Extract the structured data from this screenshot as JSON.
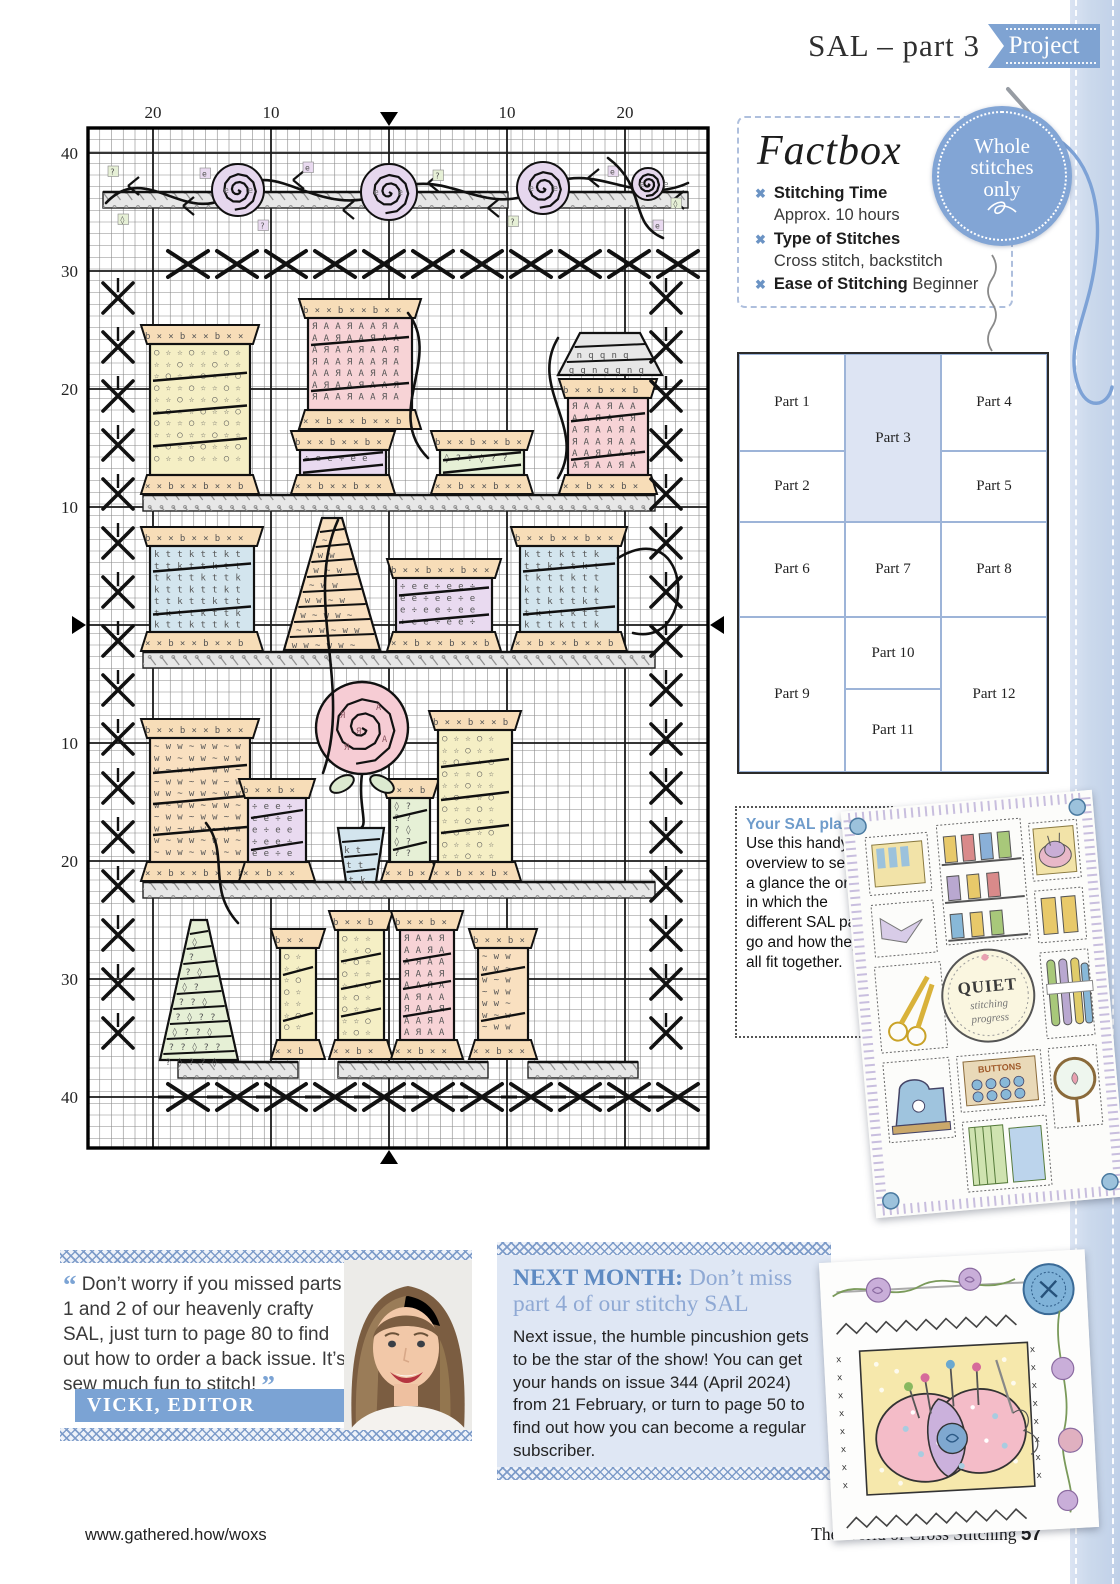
{
  "header": {
    "title": "SAL – part 3",
    "badge": "Project"
  },
  "factbox": {
    "title": "Factbox",
    "bullet": "✖",
    "items": [
      {
        "label": "Stitching Time",
        "value": "Approx. 10 hours"
      },
      {
        "label": "Type of Stitches",
        "value": "Cross stitch, backstitch"
      },
      {
        "label": "Ease of Stitching",
        "value": "Beginner"
      }
    ]
  },
  "whole_badge": {
    "lines": [
      "Whole",
      "stitches",
      "only"
    ]
  },
  "parts_grid": {
    "col_x": [
      0,
      106,
      202
    ],
    "col_w": [
      106,
      96,
      106
    ],
    "row_y": [
      0,
      97,
      168,
      263,
      335
    ],
    "row_h": [
      97,
      71,
      95,
      72,
      83
    ],
    "cells": [
      {
        "label": "Part 1",
        "col": 0,
        "row": 0,
        "rs": 1
      },
      {
        "label": "Part 2",
        "col": 0,
        "row": 1,
        "rs": 1
      },
      {
        "label": "Part 6",
        "col": 0,
        "row": 2,
        "rs": 1
      },
      {
        "label": "Part 9",
        "col": 0,
        "row": 3,
        "rs": 2
      },
      {
        "label": "Part 3",
        "col": 1,
        "row": 0,
        "rs": 2,
        "hl": true
      },
      {
        "label": "Part 7",
        "col": 1,
        "row": 2,
        "rs": 1
      },
      {
        "label": "Part 10",
        "col": 1,
        "row": 3,
        "rs": 1
      },
      {
        "label": "Part 11",
        "col": 1,
        "row": 4,
        "rs": 1
      },
      {
        "label": "Part 4",
        "col": 2,
        "row": 0,
        "rs": 1
      },
      {
        "label": "Part 5",
        "col": 2,
        "row": 1,
        "rs": 1
      },
      {
        "label": "Part 8",
        "col": 2,
        "row": 2,
        "rs": 1
      },
      {
        "label": "Part 12",
        "col": 2,
        "row": 3,
        "rs": 2
      }
    ]
  },
  "sal_plan": {
    "title": "Your SAL plan:",
    "body": "Use this handy overview to see at a glance the order in which the different SAL parts go and how they’ll all fit together."
  },
  "sampler": {
    "center_title": "QUIET",
    "center_sub1": "stitching",
    "center_sub2": "progress",
    "buttons_label": "BUTTONS"
  },
  "editor_quote": {
    "open": "“",
    "text": " Don’t worry if you missed parts 1 and 2 of our heavenly crafty SAL, just turn to page 80 to find out how to order a back issue. It’s sew much fun to stitch! ",
    "close": "”",
    "attribution": "VICKI, EDITOR"
  },
  "next_month": {
    "lead": "NEXT MONTH:",
    "headline": " Don’t miss part 4 of our stitchy SAL",
    "body": "Next issue, the humble pincushion gets to be the star of the show! You can get your hands on issue 344 (April 2024) from 21 February, or turn to page 50 to find out how you can become a regular subscriber."
  },
  "footer": {
    "url": "www.gathered.how/woxs",
    "magazine": "The World of Cross Stitching ",
    "page": "57"
  },
  "stitch_chart": {
    "cell": 11.75,
    "width": 620,
    "height": 1020,
    "bold_x": [
      65,
      183,
      301,
      419,
      537
    ],
    "bold_y": [
      25,
      143,
      261,
      379,
      497,
      615,
      733,
      851,
      969
    ],
    "top_labels": [
      {
        "t": "20",
        "x": 65
      },
      {
        "t": "10",
        "x": 183
      },
      {
        "t": "10",
        "x": 419
      },
      {
        "t": "20",
        "x": 537
      }
    ],
    "left_labels": [
      {
        "t": "40",
        "y": 25
      },
      {
        "t": "30",
        "y": 143
      },
      {
        "t": "20",
        "y": 261
      },
      {
        "t": "10",
        "y": 379
      },
      {
        "t": "10",
        "y": 615
      },
      {
        "t": "20",
        "y": 733
      },
      {
        "t": "30",
        "y": 851
      },
      {
        "t": "40",
        "y": 969
      }
    ],
    "palette": {
      "yellow": "#f5efc5",
      "pink": "#f7d3d6",
      "lav": "#e9daf0",
      "blue": "#d3e5ee",
      "green": "#e6f0d6",
      "peach": "#f9e0c0",
      "flange": "#f7ddb8",
      "shelf": "#e7e7e7",
      "rose_top": "#e6d7ee",
      "rose_big": "#f6ccd4",
      "leaf": "#dcead0"
    },
    "symbols": {
      "yellow": [
        "☆",
        "○"
      ],
      "pink": [
        "A",
        "Я"
      ],
      "lav": [
        "e",
        "÷"
      ],
      "blue": [
        "t",
        "k"
      ],
      "green": [
        "?",
        "◊"
      ],
      "peach": [
        "w",
        "~"
      ],
      "flange": [
        "×",
        "b"
      ]
    },
    "shelves": [
      {
        "x": 55,
        "y": 367,
        "w": 512
      },
      {
        "x": 55,
        "y": 524,
        "w": 512
      },
      {
        "x": 55,
        "y": 754,
        "w": 512
      }
    ],
    "shelf_segments": [
      {
        "x": 90,
        "y": 934,
        "w": 120
      },
      {
        "x": 250,
        "y": 934,
        "w": 150
      },
      {
        "x": 440,
        "y": 934,
        "w": 110
      },
      {
        "x": 15,
        "y": 64,
        "w": 130
      },
      {
        "x": 170,
        "y": 64,
        "w": 250
      },
      {
        "x": 450,
        "y": 64,
        "w": 150
      }
    ],
    "spools": [
      {
        "x": 62,
        "y": 196,
        "w": 100,
        "h": 171,
        "c": "yellow"
      },
      {
        "x": 220,
        "y": 170,
        "w": 104,
        "h": 132,
        "c": "pink"
      },
      {
        "x": 212,
        "y": 302,
        "w": 86,
        "h": 65,
        "c": "lav"
      },
      {
        "x": 352,
        "y": 302,
        "w": 84,
        "h": 65,
        "c": "green"
      },
      {
        "x": 480,
        "y": 250,
        "w": 80,
        "h": 117,
        "c": "pink"
      },
      {
        "x": 62,
        "y": 398,
        "w": 104,
        "h": 126,
        "c": "blue"
      },
      {
        "x": 308,
        "y": 430,
        "w": 96,
        "h": 94,
        "c": "lav"
      },
      {
        "x": 432,
        "y": 398,
        "w": 98,
        "h": 126,
        "c": "blue"
      },
      {
        "x": 62,
        "y": 590,
        "w": 100,
        "h": 164,
        "c": "peach"
      },
      {
        "x": 160,
        "y": 650,
        "w": 58,
        "h": 104,
        "c": "lav"
      },
      {
        "x": 302,
        "y": 650,
        "w": 40,
        "h": 104,
        "c": "green"
      },
      {
        "x": 350,
        "y": 582,
        "w": 74,
        "h": 172,
        "c": "yellow"
      },
      {
        "x": 192,
        "y": 800,
        "w": 36,
        "h": 132,
        "c": "yellow"
      },
      {
        "x": 250,
        "y": 782,
        "w": 46,
        "h": 150,
        "c": "yellow"
      },
      {
        "x": 312,
        "y": 782,
        "w": 54,
        "h": 150,
        "c": "pink"
      },
      {
        "x": 390,
        "y": 800,
        "w": 50,
        "h": 132,
        "c": "peach"
      }
    ],
    "cones": [
      {
        "x": 196,
        "y": 390,
        "w": 96,
        "h": 132,
        "c": "peach",
        "tw": 20
      },
      {
        "x": 72,
        "y": 792,
        "w": 78,
        "h": 140,
        "c": "green",
        "tw": 16
      },
      {
        "x": 470,
        "y": 205,
        "w": 104,
        "h": 42,
        "c": "shelf",
        "tw": 60
      }
    ],
    "pot": {
      "x": 250,
      "y": 700,
      "w": 46,
      "h": 54,
      "c": "blue",
      "tw": 30
    },
    "roses_top": [
      {
        "x": 150,
        "y": 62,
        "r": 26
      },
      {
        "x": 301,
        "y": 64,
        "r": 28
      },
      {
        "x": 455,
        "y": 60,
        "r": 26
      },
      {
        "x": 560,
        "y": 56,
        "r": 16
      }
    ],
    "big_rose": {
      "x": 274,
      "y": 600,
      "r": 46
    },
    "vine": "M 18 75 C 60 30 100 105 150 62 C 190 28 230 95 301 64 C 360 35 395 95 455 60 C 505 30 545 80 600 55",
    "vine_leaves": [
      [
        40,
        58
      ],
      [
        95,
        78
      ],
      [
        205,
        52
      ],
      [
        255,
        82
      ],
      [
        340,
        55
      ],
      [
        400,
        80
      ],
      [
        500,
        50
      ],
      [
        585,
        72
      ]
    ],
    "scatter": [
      {
        "x": 20,
        "y": 38,
        "c": "green",
        "s": "?"
      },
      {
        "x": 112,
        "y": 40,
        "c": "lav",
        "s": "e"
      },
      {
        "x": 215,
        "y": 34,
        "c": "lav",
        "s": "e"
      },
      {
        "x": 345,
        "y": 42,
        "c": "green",
        "s": "?"
      },
      {
        "x": 520,
        "y": 38,
        "c": "lav",
        "s": "e"
      },
      {
        "x": 583,
        "y": 70,
        "c": "green",
        "s": "◊"
      },
      {
        "x": 30,
        "y": 86,
        "c": "green",
        "s": "◊"
      },
      {
        "x": 170,
        "y": 92,
        "c": "lav",
        "s": "?"
      },
      {
        "x": 420,
        "y": 88,
        "c": "green",
        "s": "?"
      },
      {
        "x": 565,
        "y": 92,
        "c": "lav",
        "s": "e"
      }
    ],
    "swooshes": [
      "M 320 185 C 355 230 295 285 340 330",
      "M 250 392 C 215 470 265 560 235 645",
      "M 530 430 C 605 385 610 520 545 505",
      "M 150 795 C 118 760 142 726 118 695",
      "M 470 210 C 440 260 500 300 470 350",
      "M 520 30 C 560 60 540 95 575 110"
    ],
    "x_bands": {
      "top": {
        "y": 136,
        "x0": 100,
        "step": 49,
        "n": 11
      },
      "bottom": {
        "y": 969,
        "x0": 100,
        "step": 49,
        "n": 11
      },
      "left": {
        "x": 30,
        "y0": 170,
        "step": 49,
        "n": 16
      },
      "right": {
        "x": 578,
        "y0": 170,
        "step": 49,
        "n": 16
      }
    }
  }
}
